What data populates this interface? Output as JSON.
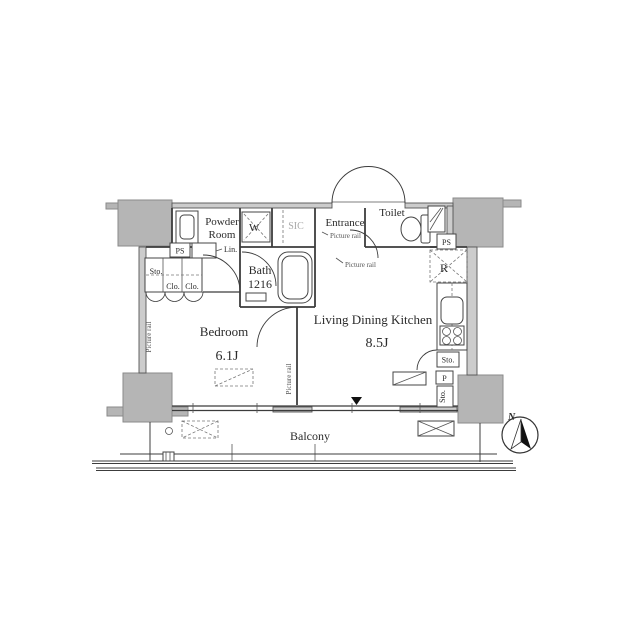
{
  "rooms": {
    "powder_room_line1": "Powder",
    "powder_room_line2": "Room",
    "bath_name": "Bath",
    "bath_size": "1216",
    "entrance": "Entrance",
    "toilet": "Toilet",
    "sic": "SIC",
    "bedroom_name": "Bedroom",
    "bedroom_size": "6.1J",
    "ldk_name": "Living Dining Kitchen",
    "ldk_size": "8.5J",
    "balcony": "Balcony"
  },
  "labels": {
    "washer": "W",
    "refrigerator": "R",
    "pipe_space": "PS",
    "linen": "Lin.",
    "storage": "Sto.",
    "closet": "Clo.",
    "pantry": "P",
    "picture_rail": "Picture rail",
    "north": "N"
  },
  "colors": {
    "column_gray": "#b5b5b5",
    "wall_gray": "#cccccc",
    "line_dark": "#3c3c3c",
    "text_light": "#a8a8a8",
    "needle_black": "#111111"
  }
}
